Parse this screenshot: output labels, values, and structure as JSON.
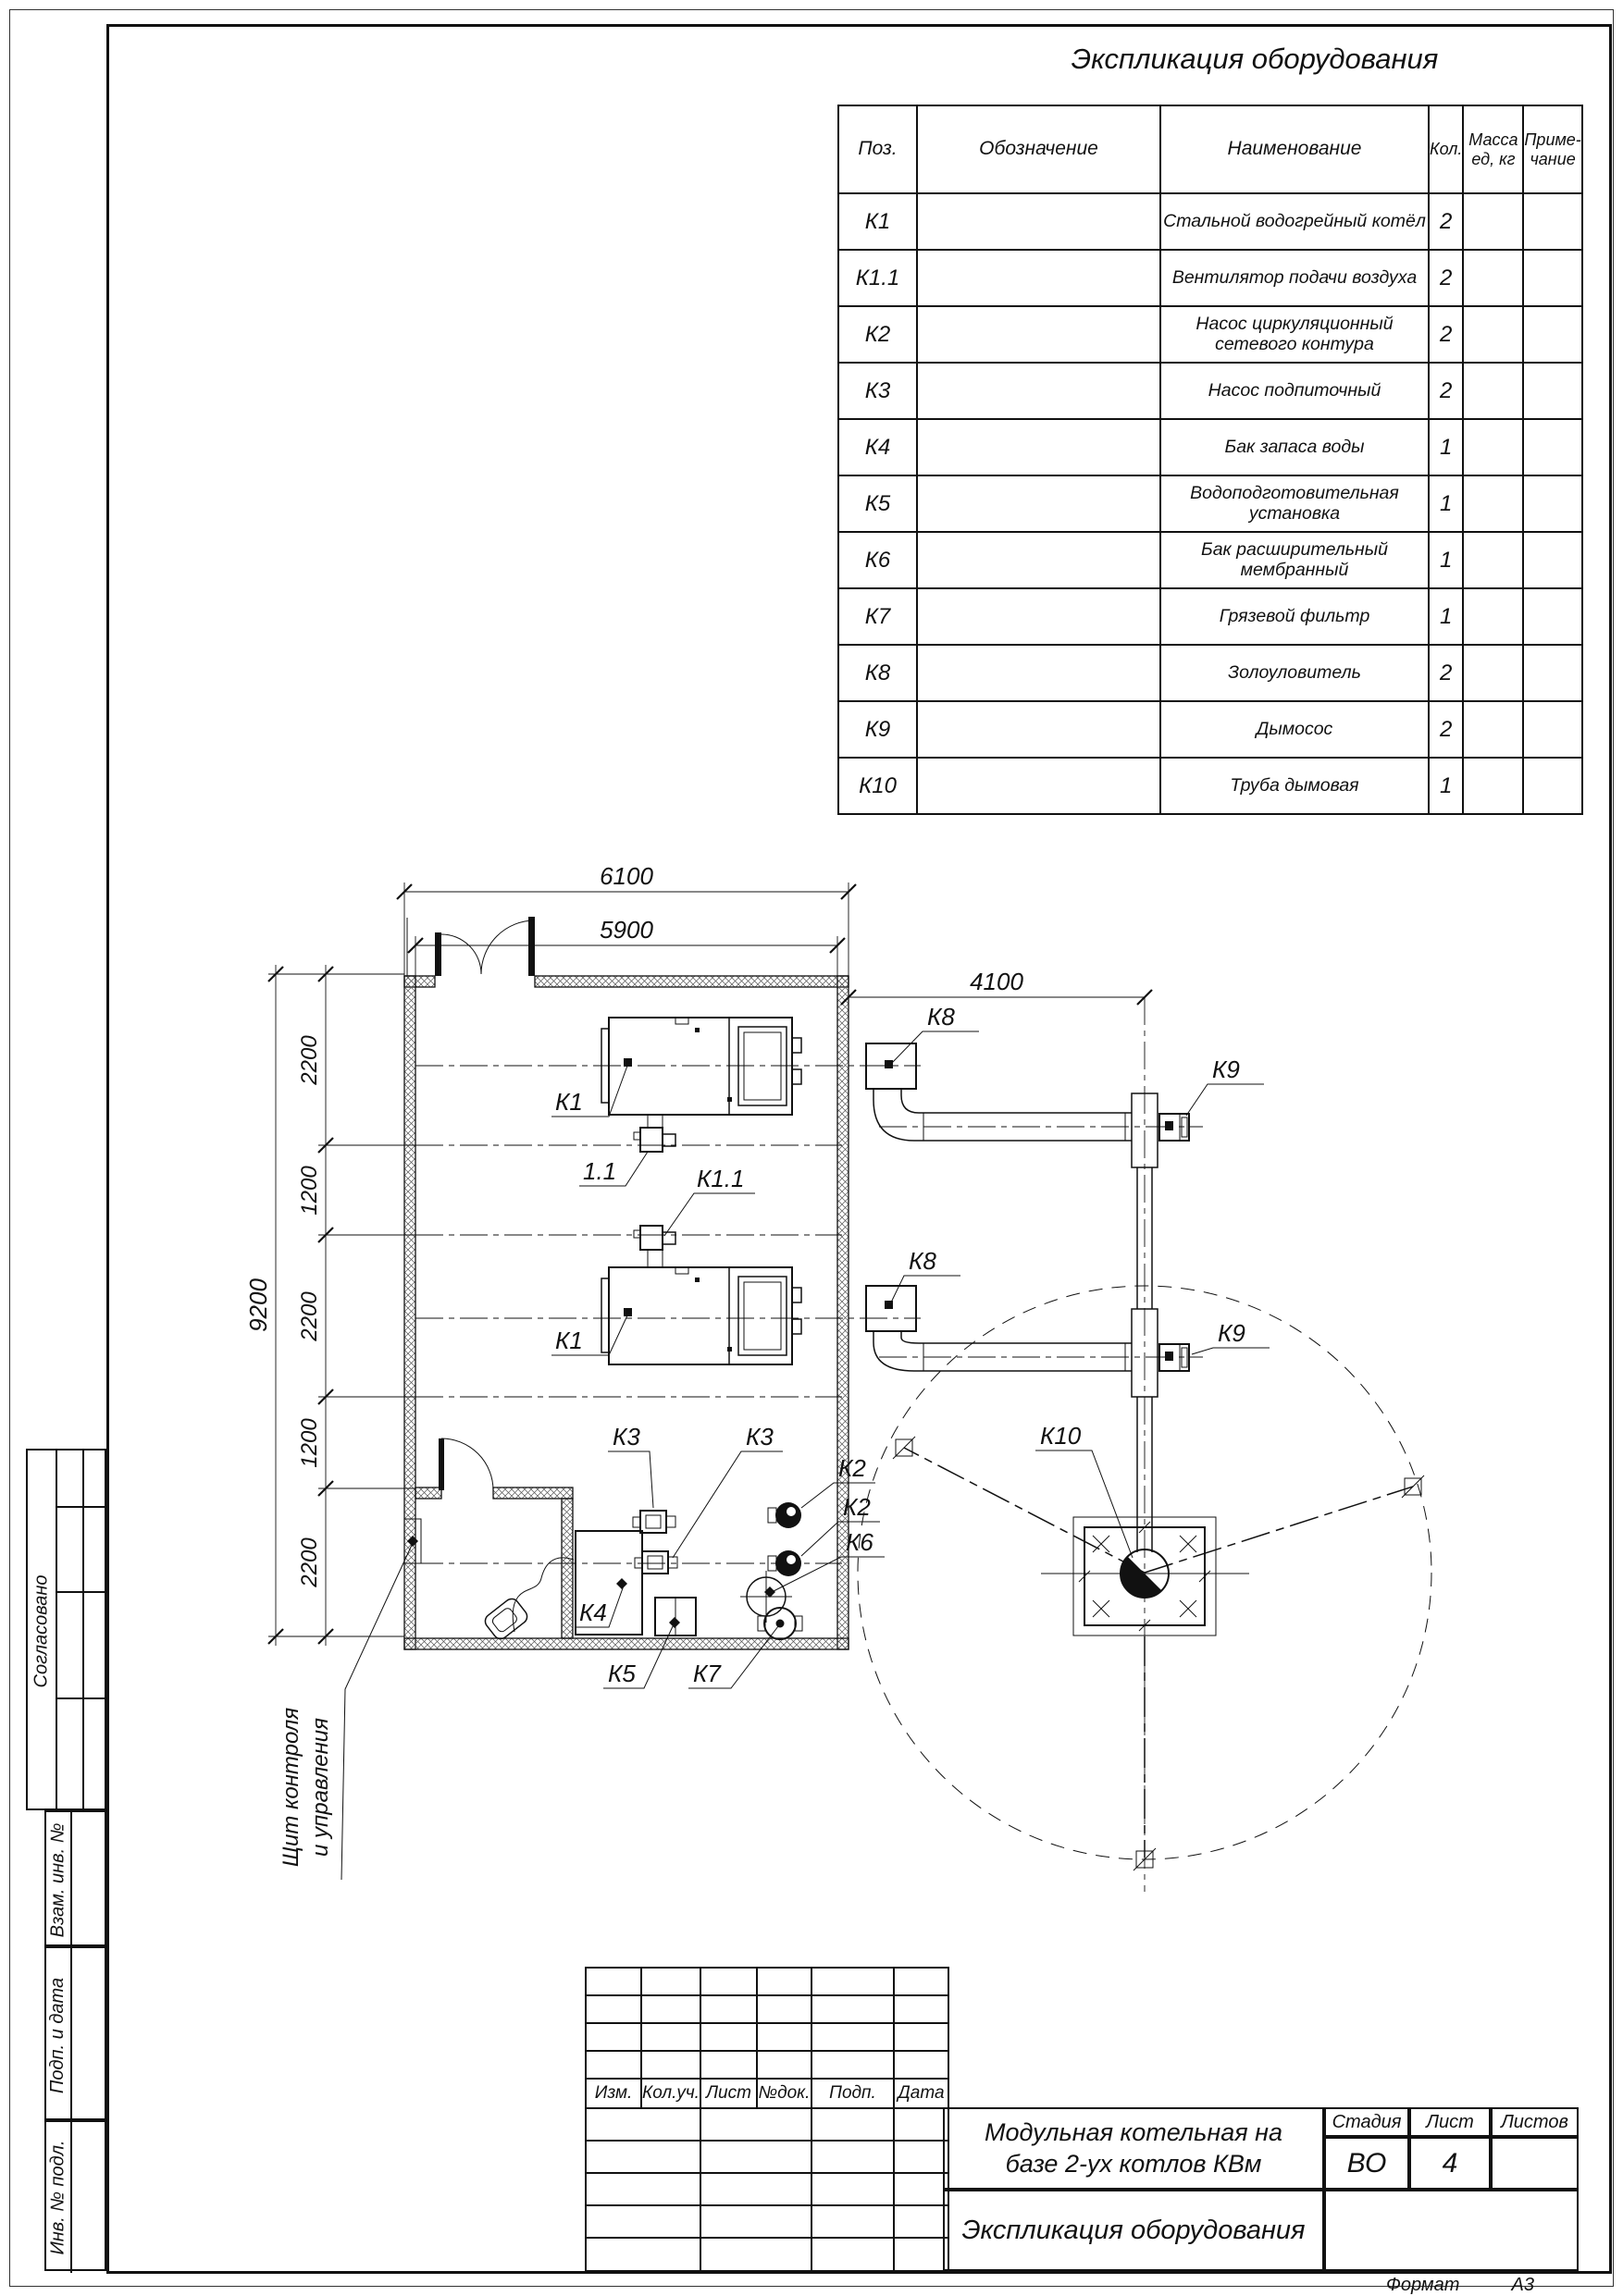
{
  "table": {
    "title": "Экспликация оборудования",
    "headers": {
      "pos": "Поз.",
      "designation": "Обозначение",
      "name": "Наименование",
      "qty": "Кол.",
      "mass": "Масса\nед, кг",
      "note": "Приме-\nчание"
    },
    "rows": [
      {
        "pos": "К1",
        "name": "Стальной водогрейный котёл",
        "qty": "2"
      },
      {
        "pos": "К1.1",
        "name": "Вентилятор подачи воздуха",
        "qty": "2"
      },
      {
        "pos": "К2",
        "name": "Насос циркуляционный\nсетевого контура",
        "qty": "2"
      },
      {
        "pos": "К3",
        "name": "Насос подпиточный",
        "qty": "2"
      },
      {
        "pos": "К4",
        "name": "Бак запаса воды",
        "qty": "1"
      },
      {
        "pos": "К5",
        "name": "Водоподготовительная установка",
        "qty": "1"
      },
      {
        "pos": "К6",
        "name": "Бак расширительный мембранный",
        "qty": "1"
      },
      {
        "pos": "К7",
        "name": "Грязевой фильтр",
        "qty": "1"
      },
      {
        "pos": "К8",
        "name": "Золоуловитель",
        "qty": "2"
      },
      {
        "pos": "К9",
        "name": "Дымосос",
        "qty": "2"
      },
      {
        "pos": "К10",
        "name": "Труба дымовая",
        "qty": "1"
      }
    ]
  },
  "plan": {
    "dims": {
      "top_outer": "6100",
      "top_inner": "5900",
      "right": "4100",
      "left_total": "9200",
      "seg1": "2200",
      "seg2": "1200",
      "seg3": "2200",
      "seg4": "1200",
      "seg5": "2200"
    },
    "labels": {
      "k1_top": "К1",
      "k1_bottom": "К1",
      "fan_11": "1.1",
      "k1_1": "К1.1",
      "k8_top": "К8",
      "k8_bottom": "К8",
      "k9_top": "К9",
      "k9_bottom": "К9",
      "k10": "К10",
      "k2_a": "К2",
      "k2_b": "К2",
      "k3_a": "К3",
      "k3_b": "К3",
      "k4": "К4",
      "k5": "К5",
      "k6": "К6",
      "k7": "К7"
    },
    "control_panel_note": {
      "line1": "Щит контроля",
      "line2": "и управления"
    }
  },
  "title_block": {
    "rev_headers": {
      "izm": "Изм.",
      "kol": "Кол.уч.",
      "list": "Лист",
      "ndoc": "№док.",
      "podp": "Подп.",
      "data": "Дата"
    },
    "project_title": {
      "line1": "Модульная котельная на",
      "line2": "базе 2-ух котлов КВм"
    },
    "stage_label": "Стадия",
    "sheet_label": "Лист",
    "sheets_label": "Листов",
    "stage_value": "ВО",
    "sheet_value": "4",
    "doc_title": "Экспликация оборудования",
    "format_label": "Формат",
    "format_value": "А3"
  },
  "side_stamp": {
    "agreed": "Согласовано",
    "vzam": "Взам. инв. №",
    "podp": "Подп. и дата",
    "inv": "Инв. № подл."
  }
}
